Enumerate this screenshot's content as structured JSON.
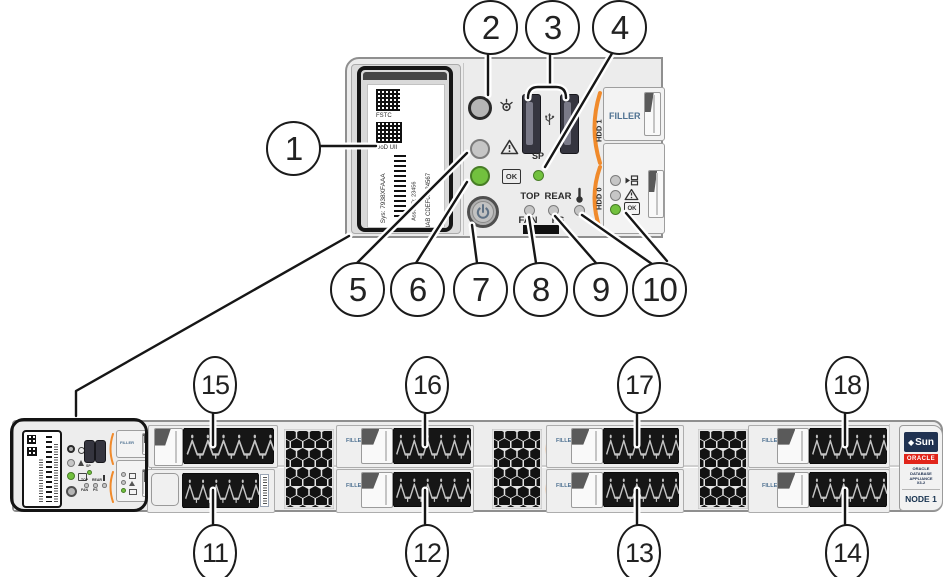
{
  "colors": {
    "accent_orange": "#F08A2B",
    "led_green": "#72C13E",
    "oracle_red": "#E1251B",
    "sun_navy": "#203251",
    "filler_blue": "#4E7191"
  },
  "callouts": [
    {
      "n": "1"
    },
    {
      "n": "2"
    },
    {
      "n": "3"
    },
    {
      "n": "4"
    },
    {
      "n": "5"
    },
    {
      "n": "6"
    },
    {
      "n": "7"
    },
    {
      "n": "8"
    },
    {
      "n": "9"
    },
    {
      "n": "10"
    },
    {
      "n": "11"
    },
    {
      "n": "12"
    },
    {
      "n": "13"
    },
    {
      "n": "14"
    },
    {
      "n": "15"
    },
    {
      "n": "16"
    },
    {
      "n": "17"
    },
    {
      "n": "18"
    }
  ],
  "detail_panel": {
    "service_label": {
      "fstc": "FSTC",
      "dod_uii": "DoD UII",
      "sys": "Sys: 7938XFAAA",
      "asset_id": "Asset ID: 23456",
      "serial": "3AB CDEF01234567"
    },
    "sp": "SP",
    "top": "TOP",
    "fan": "FAN",
    "rear": "REAR",
    "ps": "PS",
    "ok": "OK",
    "filler": "FILLER",
    "hdd1": "HDD 1",
    "hdd0": "HDD 0"
  },
  "server": {
    "filler": "FILLER",
    "hdd_bracket": "HDD",
    "badge": {
      "sun_diamond": "◆",
      "sun": "Sun",
      "oracle": "ORACLE",
      "product_lines": [
        "ORACLE",
        "DATABASE",
        "APPLIANCE",
        "X3-2"
      ],
      "node": "NODE 1"
    }
  }
}
